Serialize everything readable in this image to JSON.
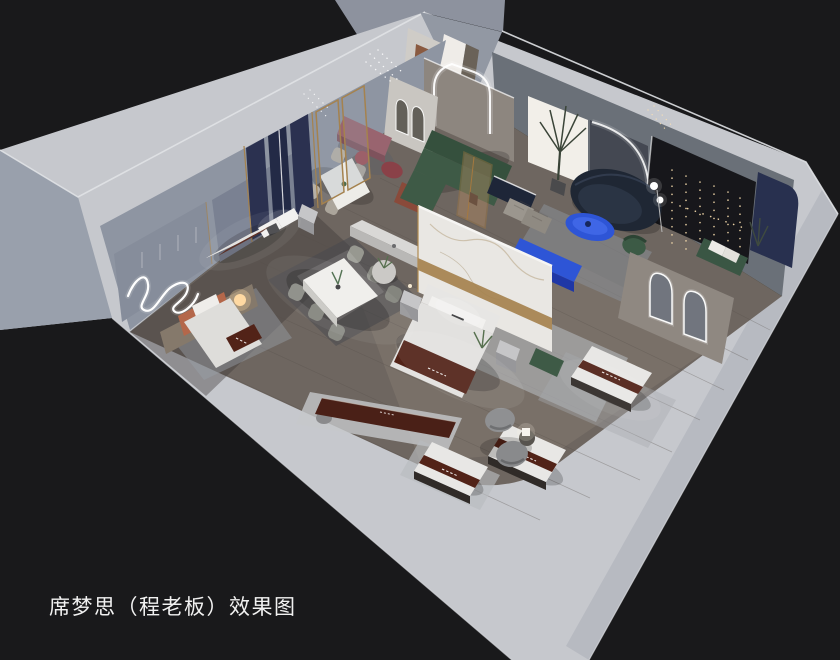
{
  "meta": {
    "type": "3d-interior-render",
    "view": "isometric cutaway aerial view",
    "subject": "Simmons mattress showroom effect rendering"
  },
  "caption": {
    "text": "席梦思（程老板）效果图"
  },
  "colors": {
    "background": "#19191b",
    "ground": "#99a0ac",
    "ground_far": "#8d929e",
    "wall": "#c6c8cd",
    "wall_shadow": "#b7bac1",
    "wall_interior_left": "#8e95a2",
    "wall_interior_right": "#6a7078",
    "floor": "#6e6660",
    "floor_light": "#93867a",
    "marble": "#e9e7e3",
    "gold": "#a5824e",
    "accent_blue": "#2e55d6",
    "accent_blue_dark": "#1f37a6",
    "navy_sofa": "#1f2734",
    "navy_drape": "#2b3150",
    "green_sofa": "#3e5a46",
    "mauve_bench": "#99646f",
    "terracotta": "#b4674a",
    "mattress_runner": "#522318",
    "bedding_white": "#e2e1df",
    "rug_light": "#b4b7bd",
    "rug_dark": "#45474e",
    "led_white": "#ffffff",
    "fairy_light": "#ffe3b2",
    "lamp_glow": "#ffd9a2",
    "caption_text": "#f1f1f1"
  },
  "scene": {
    "rooms": [
      "bedroom display with navy drape panels",
      "bedroom display with terracotta headboard",
      "small dining set",
      "main dining set",
      "living lounge with curved sofa",
      "master bed display with marble partition",
      "dark feature wall lounge",
      "arched mirror alcove",
      "open mattress display area"
    ],
    "objects": [
      "wavy-neon-wall-light",
      "pendant-light-cluster",
      "navy-drape-panels",
      "gold-frame-screens",
      "display-bed",
      "terracotta-headboard",
      "glow-table-lamp",
      "dining-table",
      "dining-chairs",
      "mauve-bench",
      "maroon-armchair",
      "green-sectional-sofa",
      "backlit-panel",
      "palm-plant",
      "led-arch-portal",
      "arch-niche-wall",
      "navy-curved-sofa",
      "blue-coffee-table",
      "blue-tv-console",
      "tv-bench",
      "fabric-ottomans",
      "marble-partition-wall",
      "nightstand",
      "console-table",
      "round-side-table",
      "dark-feature-wall",
      "fairy-string-lights",
      "navy-wall-panel",
      "green-bench",
      "arched-mirrors",
      "mattress-display",
      "upholstered-daybed",
      "swivel-pod-chairs",
      "area-rug",
      "entry-door",
      "floor-lamp",
      "green-velvet-chair"
    ]
  }
}
